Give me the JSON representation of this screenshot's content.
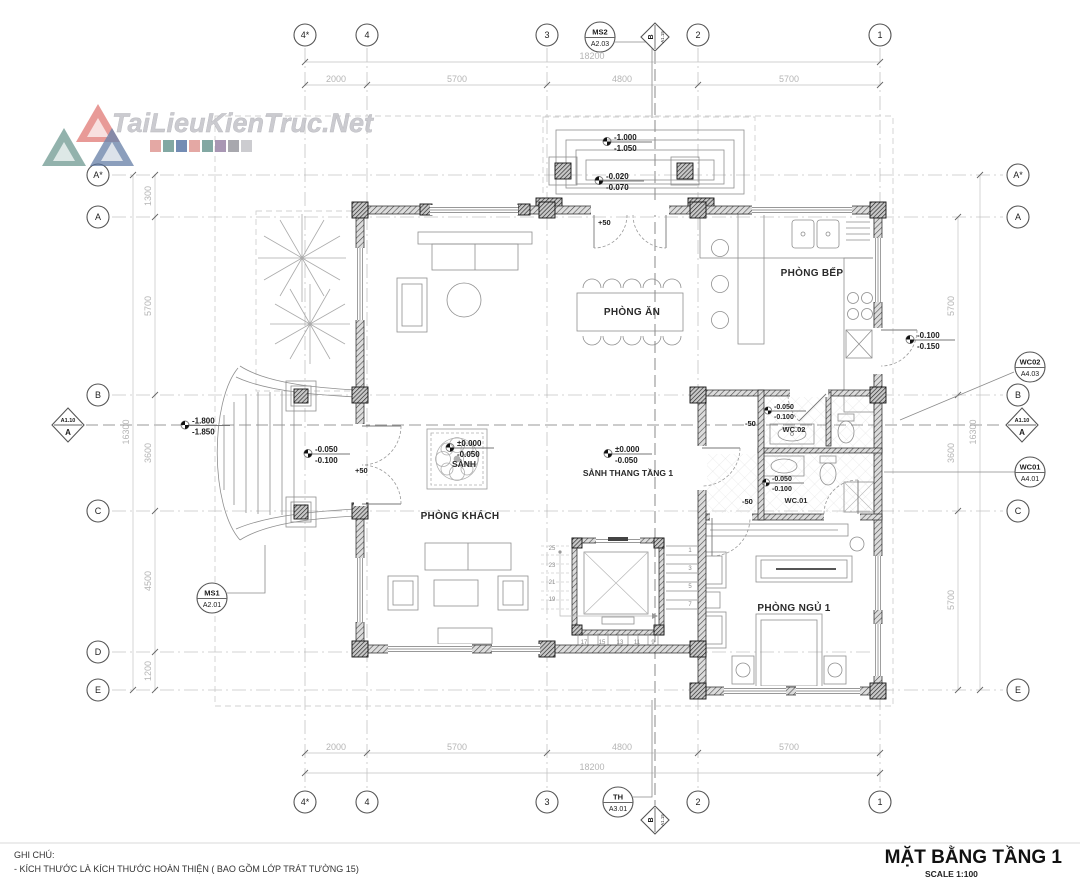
{
  "watermark": {
    "brand": "TaiLieuKienTruc.Net"
  },
  "title_block": {
    "title": "MẶT BẰNG TẦNG 1",
    "scale": "SCALE 1:100"
  },
  "notes": {
    "heading": "GHI CHÚ:",
    "line1": "- KÍCH THƯỚC LÀ KÍCH THƯỚC HOÀN THIỆN ( BAO GỒM LỚP TRÁT TƯỜNG 15)"
  },
  "grid": {
    "top": [
      "4*",
      "4",
      "3",
      "2",
      "1"
    ],
    "bottom": [
      "4*",
      "4",
      "3",
      "2",
      "1"
    ],
    "left": [
      "A*",
      "A",
      "B",
      "C",
      "D",
      "E"
    ],
    "right": [
      "A*",
      "A",
      "B",
      "C",
      "E"
    ]
  },
  "dims": {
    "top_total": "18200",
    "top_segments": [
      "2000",
      "5700",
      "4800",
      "5700"
    ],
    "bottom_total": "18200",
    "bottom_segments": [
      "2000",
      "5700",
      "4800",
      "5700"
    ],
    "left_total": "16300",
    "left_segments": [
      "1300",
      "5700",
      "3600",
      "4500",
      "1200"
    ],
    "right_total": "16300",
    "right_segments": [
      "5700",
      "3600",
      "5700"
    ]
  },
  "rooms": {
    "kitchen": "PHÒNG BẾP",
    "dining": "PHÒNG ĂN",
    "living": "PHÒNG KHÁCH",
    "bedroom1": "PHÒNG NGỦ 1",
    "lobby": "SẢNH",
    "stair_hall": "SẢNH THANG TẦNG 1",
    "wc02": "WC.02",
    "wc01": "WC.01"
  },
  "levels": {
    "porch_top_upper": "-1.000",
    "porch_top_lower": "-1.050",
    "porch_floor_upper": "-0.020",
    "porch_floor_lower": "-0.070",
    "kitchen_exit_upper": "-0.100",
    "kitchen_exit_lower": "-0.150",
    "wc02_upper": "-0.050",
    "wc02_lower": "-0.100",
    "wc01_upper": "-0.050",
    "wc01_lower": "-0.100",
    "left_door_upper": "-0.050",
    "left_door_lower": "-0.100",
    "left_stair_upper": "-1.800",
    "left_stair_lower": "-1.850",
    "lobby_upper": "±0.000",
    "lobby_lower": "-0.050",
    "stairhall_upper": "±0.000",
    "stairhall_lower": "-0.050",
    "plus50_top": "+50",
    "plus50_left": "+50",
    "minus50_wc02": "-50",
    "minus50_wc01": "-50"
  },
  "callouts": {
    "ms2": {
      "top": "MS2",
      "bottom": "A2.03"
    },
    "th": {
      "top": "TH",
      "bottom": "A3.01"
    },
    "ms1": {
      "top": "MS1",
      "bottom": "A2.01"
    },
    "wc02": {
      "top": "WC02",
      "bottom": "A4.03"
    },
    "wc01": {
      "top": "WC01",
      "bottom": "A4.01"
    },
    "section_a": {
      "sheet": "A1.10",
      "label": "A"
    },
    "section_b": {
      "sheet": "A1.15",
      "label": "B"
    }
  },
  "stairs": {
    "left_numbers": [
      "25",
      "23",
      "21",
      "19"
    ],
    "right_numbers": [
      "1",
      "3",
      "5",
      "7"
    ],
    "bottom_numbers": [
      "17",
      "15",
      "13",
      "11",
      "9"
    ]
  },
  "colors": {
    "accent_red": "#e09a95",
    "accent_teal": "#6d9a93",
    "accent_blue": "#5b79a8",
    "accent_purple": "#9b86a8",
    "accent_gray": "#9a9aa0",
    "accent_lightgray": "#c4c4c8"
  }
}
